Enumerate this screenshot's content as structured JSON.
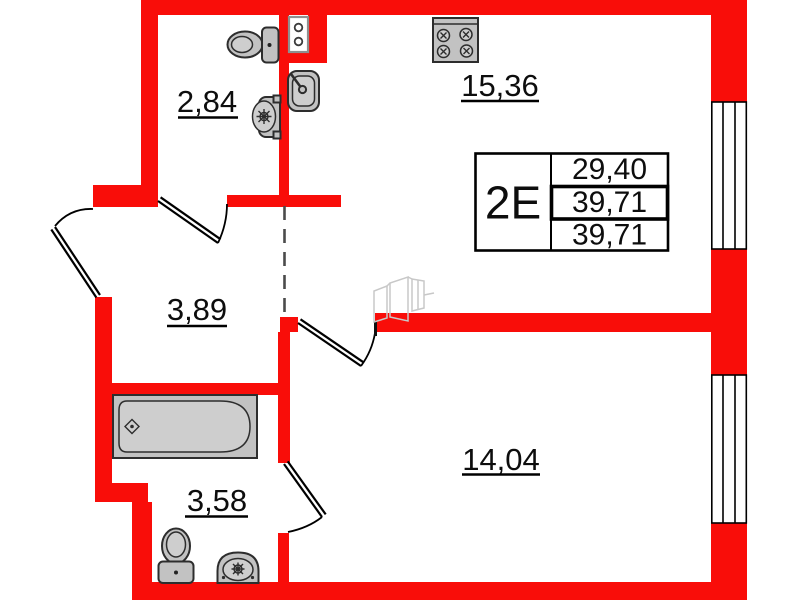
{
  "unit_table": {
    "unit_label": "2Е",
    "values": [
      "29,40",
      "39,71",
      "39,71"
    ]
  },
  "room_areas": {
    "wc": "2,84",
    "kitchen_living": "15,36",
    "hallway": "3,89",
    "bathroom": "3,58",
    "room": "14,04"
  },
  "colors": {
    "wall": "#f90d09",
    "fixture_fill": "#c2c2c2",
    "fixture_stroke": "#2d2d2d",
    "line_black": "#000000",
    "dashed_boundary": "#4b4b4b",
    "faint_sketch": "#c8c8c8",
    "panel_border": "#8f8f8f",
    "background": "#ffffff"
  },
  "icons": {
    "wc_toilet": "toilet-icon",
    "wc_washbasin": "washbasin-icon",
    "kitchen_sink": "sink-icon",
    "stove": "stove-icon",
    "electrical_panel": "electrical-panel-icon",
    "bathtub": "bathtub-icon",
    "bathroom_toilet": "toilet-icon",
    "bathroom_sink": "sink-icon",
    "window": "window-icon",
    "door": "door-swing-icon",
    "niche_sketch": "furniture-sketch-icon"
  }
}
